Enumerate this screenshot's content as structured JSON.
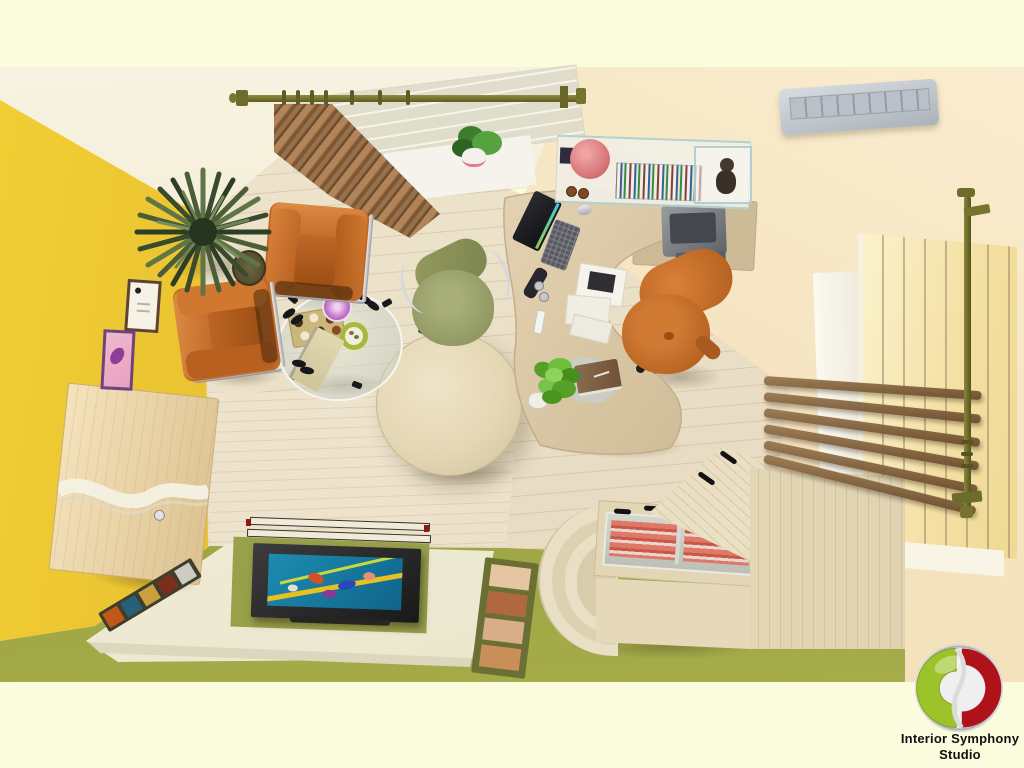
{
  "meta": {
    "type": "3d-render-top-view",
    "subject": "Top-down 3D interior render of a home office / study room",
    "canvas": {
      "width": 1024,
      "height": 768
    }
  },
  "branding": {
    "logo_text_line1": "Interior Symphony",
    "logo_text_line2": "Studio",
    "logo_colors": {
      "green": "#9CC32A",
      "red": "#AF1016",
      "ring": "#C7C7C7"
    }
  },
  "palette": {
    "background_cream": "#FBFBDD",
    "ceiling_white": "#F7F3E1",
    "wall_peach": "#F8E9C8",
    "wall_yellow": "#EFCB30",
    "wall_olive": "#8D9238",
    "floor_wood": "#EADFC7",
    "floor_green": "#9AA042",
    "platform_cream": "#F2EEDA",
    "leather_orange": "#C6722E",
    "chair_olive": "#9AA16C",
    "curtain_brown": "#A07650",
    "rod_brass": "#6F6D2C",
    "desk_wood": "#DCCAA9",
    "cabinet_wood": "#E5D9BC",
    "slat_brown": "#82603C",
    "ac_silver": "#C3C9CF",
    "tv_screen_teal": "#1C82A4",
    "display_red": "#DC6A5C"
  },
  "objects": [
    {
      "name": "window-top",
      "label": "Window with brass curtain rod and brown curtain"
    },
    {
      "name": "ac-unit",
      "label": "Ceiling air conditioner"
    },
    {
      "name": "wall-shelf",
      "label": "Glass wall shelf with books, vase and teddy display box"
    },
    {
      "name": "computer-desk",
      "label": "Curved computer desk with monitor, keyboard, mouse and documents"
    },
    {
      "name": "printer",
      "label": "Printer on side table"
    },
    {
      "name": "executive-chair",
      "label": "Orange executive chair"
    },
    {
      "name": "task-chair",
      "label": "Olive task chair"
    },
    {
      "name": "armchairs",
      "label": "Two orange leather armchairs with chrome frames"
    },
    {
      "name": "coffee-table",
      "label": "Glass coffee table with snack tray, plates and notepad"
    },
    {
      "name": "round-table",
      "label": "Round wooden table"
    },
    {
      "name": "floor-plant",
      "label": "Large potted plant"
    },
    {
      "name": "desk-plant",
      "label": "Small green desk plant with notebook"
    },
    {
      "name": "tv-platform",
      "label": "Floor platform with flat TV on green mat"
    },
    {
      "name": "sideboard",
      "label": "Wall-mounted wooden sideboard with wave inlay"
    },
    {
      "name": "display-cabinet",
      "label": "Display cabinet with curved steps and glass top"
    },
    {
      "name": "slat-blind",
      "label": "Wooden slat blind"
    },
    {
      "name": "window-right",
      "label": "Tall sunlit window with vertical brass rod"
    },
    {
      "name": "wall-frames",
      "label": "Certificate and art frames on wall"
    },
    {
      "name": "photo-strips",
      "label": "Photo strips on floor"
    }
  ]
}
